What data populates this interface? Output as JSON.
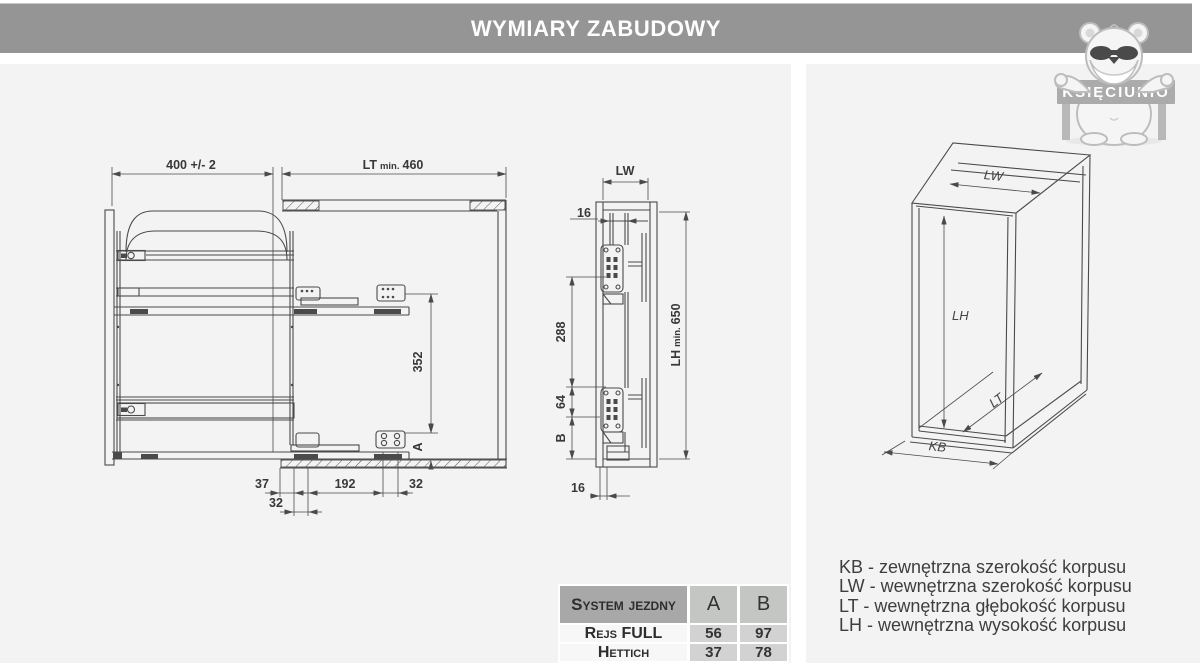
{
  "header": {
    "title": "WYMIARY ZABUDOWY"
  },
  "logo": {
    "text": "KSIĘCIUNIO"
  },
  "side_view": {
    "dim_width": "400 +/- 2",
    "dim_depth_prefix": "LT",
    "dim_depth_min": "min.",
    "dim_depth_value": "460",
    "dim_352": "352",
    "dim_a": "A",
    "dim_37": "37",
    "dim_192": "192",
    "dim_32": "32",
    "dim_32b": "32"
  },
  "front_view": {
    "dim_lw": "LW",
    "dim_16_top": "16",
    "dim_288": "288",
    "dim_64": "64",
    "dim_b": "B",
    "lh_prefix": "LH",
    "lh_min": "min.",
    "lh_value": "650",
    "dim_16_bottom": "16"
  },
  "iso_view": {
    "label_lw": "LW",
    "label_lh": "LH",
    "label_lt": "LT",
    "label_kb": "KB"
  },
  "table": {
    "headers": [
      "System jezdny",
      "A",
      "B"
    ],
    "rows": [
      [
        "Rejs FULL",
        "56",
        "97"
      ],
      [
        "Hettich",
        "37",
        "78"
      ]
    ]
  },
  "legend": {
    "lines": [
      "KB - zewnętrzna szerokość korpusu",
      "LW - wewnętrzna szerokość korpusu",
      "LT - wewnętrzna głębokość korpusu",
      "LH - wewnętrzna wysokość korpusu"
    ]
  }
}
